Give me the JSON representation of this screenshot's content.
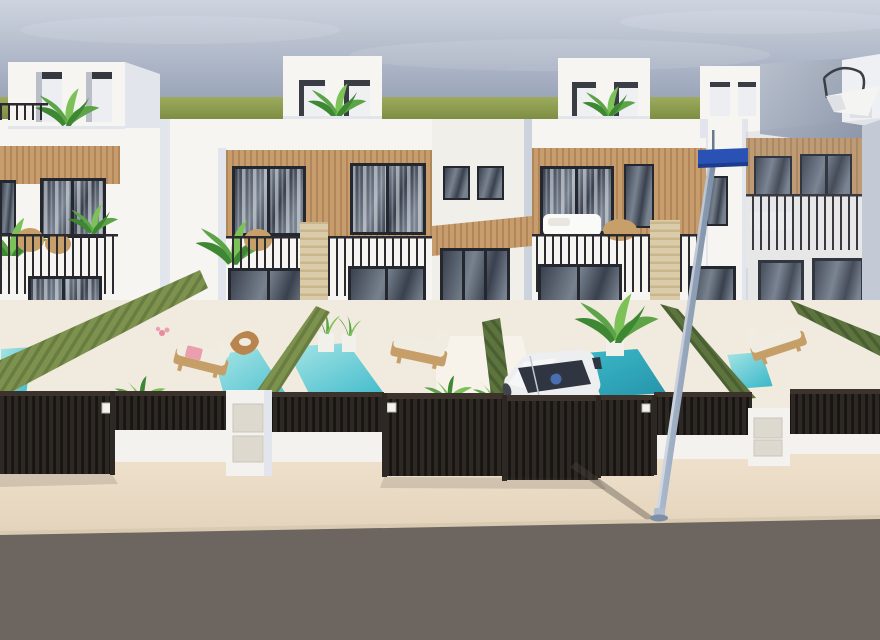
{
  "scene": {
    "type": "architectural-3d-render",
    "description": "Front elevated view of a row of modern white two-storey villas with rooftop terraces, wood-clad window bands, dark balcony railings, green hedge garden walls, private turquoise plunge pools, sun loungers, a parked white car, dark slatted street gates, beige sidewalk, asphalt road and a street lamp with a blue sign.",
    "time_of_day": "daytime",
    "objects": [
      "sky",
      "horizon-greenery",
      "rooftop-penthouses",
      "rooftop-plants",
      "cantilever-umbrella",
      "white-villa-facades",
      "wood-cladding",
      "windows",
      "balcony-railings",
      "balcony-furniture",
      "travertine-piers",
      "hedge-walls",
      "plunge-pools",
      "sun-loungers",
      "pink-towel",
      "wood-stool",
      "potted-plants",
      "white-car",
      "driver-figure",
      "slatted-gates",
      "meter-pillars",
      "house-number-plaques",
      "street-lamp",
      "blue-street-sign",
      "sidewalk",
      "road",
      "pole-shadow"
    ]
  },
  "palette": {
    "sky_top": "#ced5df",
    "sky_mid": "#a9b2c4",
    "sky_bottom": "#8b96ac",
    "grass_top": "#9cab5c",
    "grass_bottom": "#78883f",
    "wall": "#f6f5f2",
    "wall_warm": "#f1efe9",
    "shade_light": "#e2e5ec",
    "shade_mid": "#cdd3dd",
    "shade_dark": "#b6bdcb",
    "far_gray1": "#b9c1ce",
    "far_gray2": "#8f99ab",
    "wood1": "#c79d6d",
    "wood2": "#b1875a",
    "frame": "#24272d",
    "glass1": "#3a414e",
    "glass2": "#78828f",
    "curtain": "#d6d9de",
    "rail": "#2b2b30",
    "hedge_l1": "#7e924f",
    "hedge_l2": "#697d41",
    "hedge_d1": "#5d743f",
    "hedge_d2": "#4b6032",
    "pool1": "#a9e6e7",
    "pool2": "#3cb9c9",
    "pool_deep": "#2796ad",
    "coping": "#f3ecdc",
    "terrace": "#f1eadf",
    "terrace_light": "#f8f3ea",
    "trav1": "#dbcca9",
    "trav2": "#c9b68d",
    "fence1": "#2d2824",
    "fence2": "#181412",
    "fence_rail": "#3b332c",
    "pillar": "#f4f2ee",
    "panel": "#ddd9cf",
    "sidewalk1": "#f2e6d2",
    "sidewalk2": "#e4d3bb",
    "road": "#6d6660",
    "road_edge": "#d9cab2",
    "pole1": "#aebccf",
    "pole2": "#7d8fa6",
    "sign_blue": "#2a52b4",
    "car_body": "#eceef0",
    "car_shade": "#c3c8cf",
    "car_glass": "#2f3642",
    "car_person": "#4a6fb0",
    "lounger_wood": "#c69f68",
    "cushion": "#f1ece2",
    "towel": "#eb9fae",
    "plant1": "#5da448",
    "plant2": "#3e8733",
    "plant3": "#7cc258",
    "rattan": "#c7a069",
    "pot": "#f2f0ea",
    "stool": "#b9854e"
  }
}
